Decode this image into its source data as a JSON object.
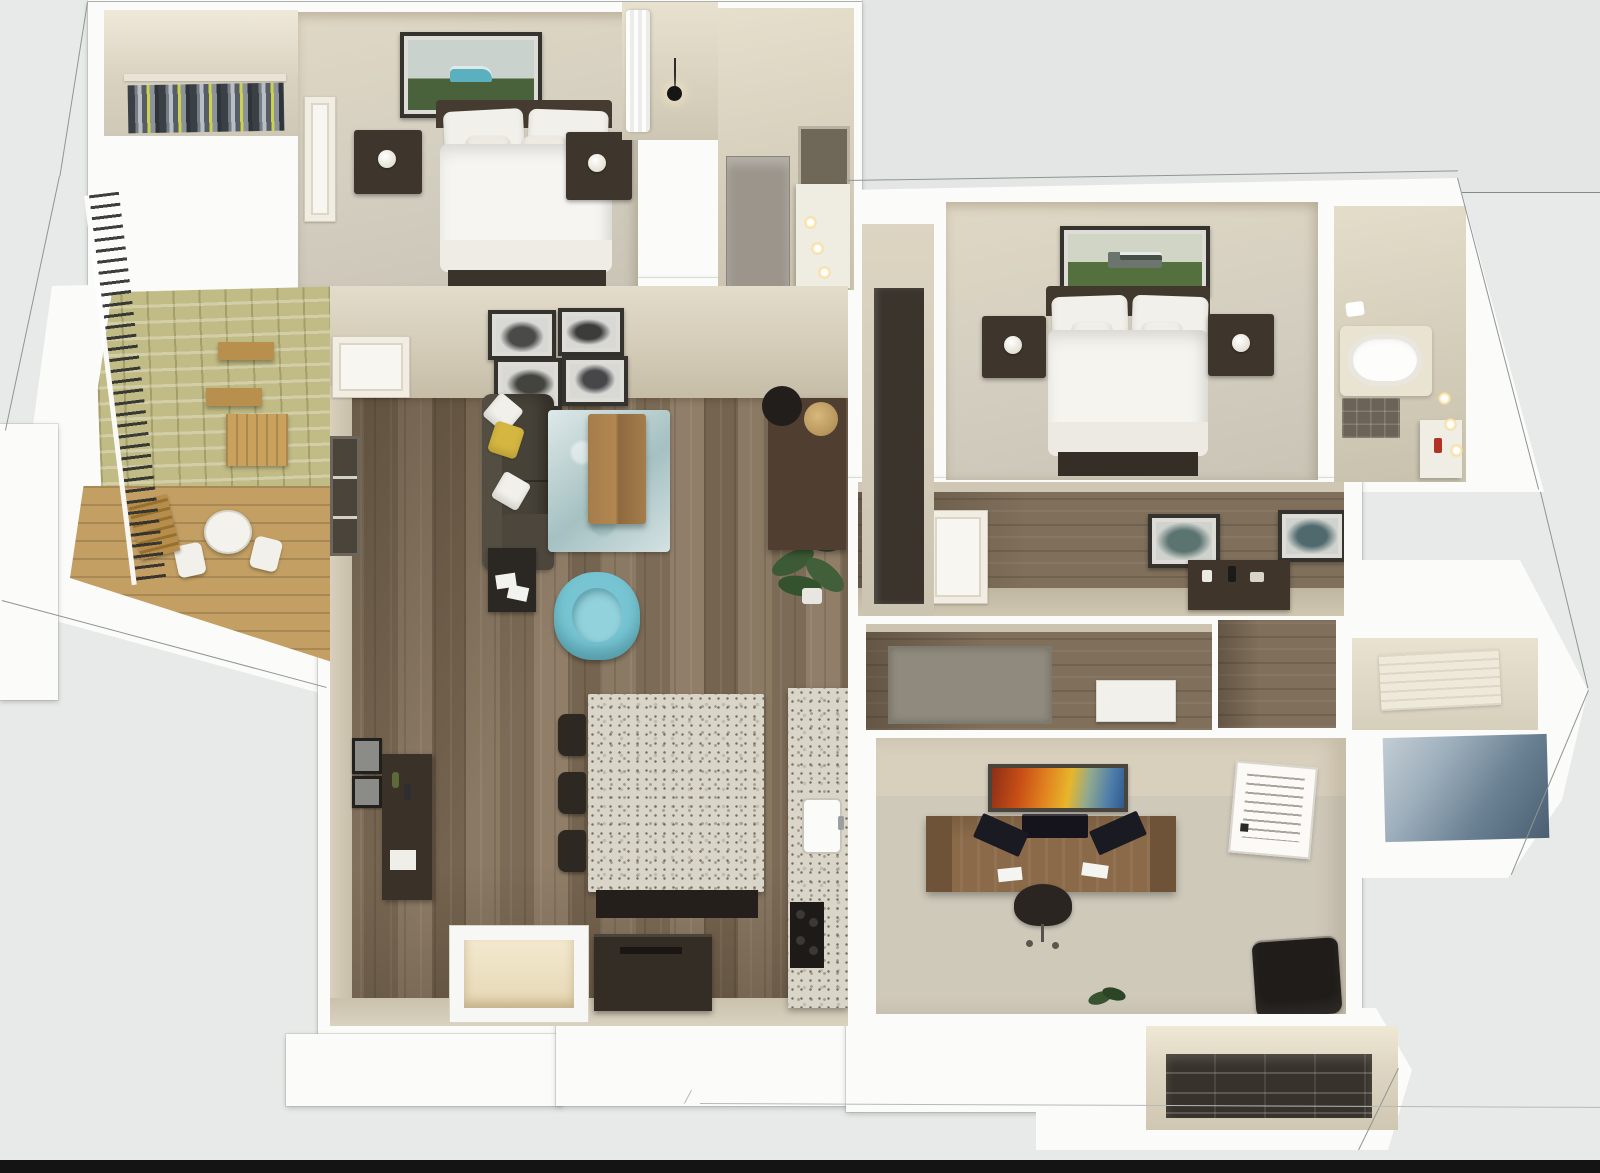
{
  "scene": {
    "type": "3d-floor-plan-rendering",
    "view": "isometric-top-down-cutaway",
    "background_color": "#e8eae9",
    "letterbox_bar_color": "#141414",
    "wall_color": "#fbfbf9",
    "outline_color": "#8e9593"
  },
  "palette": {
    "living_wood_floor": "#84735f",
    "hall_wood_floor": "#7f6f5b",
    "bedroom_carpet": "#d5d0c2",
    "wall_tan": "#d2cab6",
    "granite_counter": "#d9d5c9",
    "accent_armchair_teal": "#77c5d3",
    "rug_blue": "#bdd2d3",
    "pillow_yellow": "#d4b640",
    "balcony_brick_wall": "#c1bb85",
    "balcony_wood_deck": "#c39f63",
    "dark_furniture": "#3a332b",
    "desk_wood": "#8a6a48",
    "exterior_shadow_blue": "#698092"
  },
  "rooms": [
    {
      "id": "walk-in-closet",
      "label": "Walk-in Closet",
      "furniture": [
        "hanging clothes rack"
      ]
    },
    {
      "id": "primary-bedroom",
      "label": "Primary Bedroom",
      "furniture": [
        "bed with dark headboard",
        "two nightstands",
        "table lamps",
        "framed van artwork",
        "panel door"
      ]
    },
    {
      "id": "primary-bathroom",
      "label": "Primary Bathroom",
      "furniture": [
        "shower curtain",
        "pendant light",
        "linen cabinet",
        "vanity with mirror",
        "vanity lights"
      ]
    },
    {
      "id": "balcony",
      "label": "Balcony",
      "furniture": [
        "metal railing",
        "brick accent wall",
        "wall shelves",
        "storage crate",
        "bistro table",
        "two chairs",
        "folding chair"
      ]
    },
    {
      "id": "living-room",
      "label": "Living Room",
      "furniture": [
        "sectional sofa",
        "yellow pillow",
        "white pillows",
        "area rug",
        "wood coffee table",
        "teal accent armchair",
        "side table",
        "floor plant",
        "console with lamp and ottoman",
        "gallery of four frames",
        "media cabinet",
        "two small wall frames",
        "tv cabinet",
        "balcony door",
        "window"
      ]
    },
    {
      "id": "kitchen",
      "label": "Kitchen",
      "furniture": [
        "granite island",
        "three bar stools",
        "granite wall counter",
        "sink",
        "range"
      ]
    },
    {
      "id": "entry",
      "label": "Entry Alcove",
      "furniture": [
        "recessed doorway"
      ]
    },
    {
      "id": "hallway",
      "label": "Hallway",
      "furniture": [
        "panel door",
        "two framed prints",
        "console table"
      ]
    },
    {
      "id": "hall-closet",
      "label": "Hall Closet",
      "furniture": [
        "tall dark cabinet"
      ]
    },
    {
      "id": "bedroom-2",
      "label": "Bedroom 2",
      "furniture": [
        "bed with dark headboard",
        "two nightstands",
        "table lamps",
        "framed truck artwork"
      ]
    },
    {
      "id": "bathroom-2",
      "label": "Bathroom 2",
      "furniture": [
        "bathtub",
        "tile shower floor",
        "vanity with red bottle",
        "sconce lights",
        "towel"
      ]
    },
    {
      "id": "den",
      "label": "Den / Laundry",
      "furniture": [
        "gray mat",
        "white cabinet"
      ]
    },
    {
      "id": "office",
      "label": "Office",
      "furniture": [
        "executive desk",
        "three monitors",
        "task chair",
        "abstract artwork",
        "framed quote print",
        "dark lounge chair",
        "small plant"
      ]
    },
    {
      "id": "linen-closet",
      "label": "Bottom Closet",
      "furniture": [
        "dark shelving unit"
      ]
    }
  ]
}
